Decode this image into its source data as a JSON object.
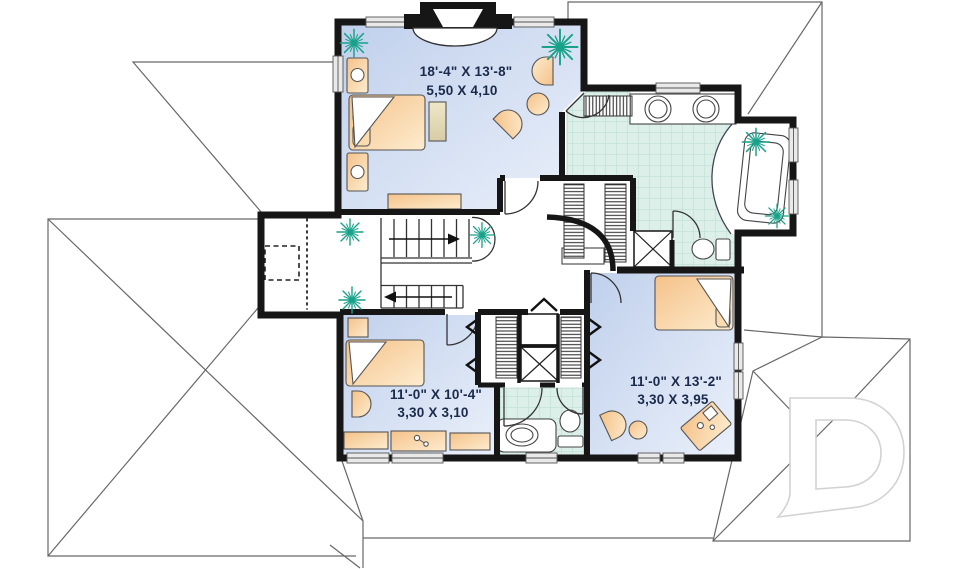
{
  "page": {
    "type": "architectural second-floor plan drawing",
    "background": "#ffffff"
  },
  "rooms": {
    "master_bedroom": {
      "dim_imperial": "18'-4\" X 13'-8\"",
      "dim_metric": "5,50 X 4,10"
    },
    "bedroom_2": {
      "dim_imperial": "11'-0\" X 10'-4\"",
      "dim_metric": "3,30 X 3,10"
    },
    "bedroom_3": {
      "dim_imperial": "11'-0\" X 13'-2\"",
      "dim_metric": "3,30 X 3,95"
    }
  },
  "watermark": {
    "letter": "D"
  },
  "colors": {
    "wall": "#161616",
    "room_fill_start": "#c3d2ec",
    "room_fill_end": "#e9eff9",
    "tile_fill": "#dcefe8",
    "tile_line": "#bfe0d4",
    "furniture_start": "#f5c289",
    "furniture_end": "#fdeccf",
    "plant": "#17a289",
    "label_text": "#1b2a4a",
    "roof_line": "#666666",
    "window_fill": "#e9e9e9"
  }
}
